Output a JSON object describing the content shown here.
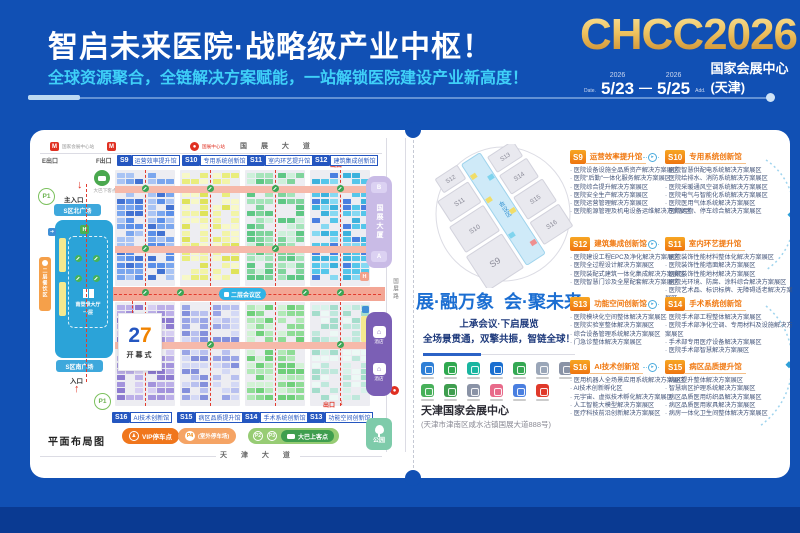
{
  "colors": {
    "bg": "#1150b4",
    "footer": "#0a3a92",
    "cyan": "#3fd0f8",
    "gold": "#e8b64f",
    "orange": "#f07810",
    "blue": "#2456c0"
  },
  "header": {
    "title": "智启未来医院·战略级产业中枢！",
    "subtitle": "全球资源聚合，全链解决方案赋能，一站解锁医院建设产业新高度！",
    "brand": "CHCC2026",
    "date_label": "Date.",
    "addr_label": "Add.",
    "year_start": "2026",
    "year_end": "2026",
    "date_start": "5/23",
    "date_sep": "—",
    "date_end": "5/25",
    "venue": "国家会展中心(天津)"
  },
  "floorplan": {
    "caption": "平面布局图",
    "roads": {
      "top": "国 展 大 道",
      "bottom": "天 津 大 道",
      "right": "国展路"
    },
    "station_label": "国家会展中心站",
    "metro_badge_label": "国展中心站",
    "exits": {
      "e": "E出口",
      "f": "F出口",
      "top": "出口",
      "bottom": "出口"
    },
    "main_entrance": "主入口",
    "south_entrance": "入口",
    "plaza_north": "S区北广场",
    "plaza_south": "S区南广场",
    "drop_off": "大巴下客点",
    "registration_line1": "南登录大厅",
    "registration_line2": "一层",
    "dining": "二层餐饮区",
    "corridor": "二层会议区",
    "opening": {
      "num_left": "2",
      "num_right": "7",
      "label": "开幕式"
    },
    "tower": {
      "b": "B",
      "name": "国展大厦",
      "a": "A"
    },
    "hotel_label": "酒店",
    "park": "公园",
    "parking": "P1",
    "legend": {
      "vip": "VIP停车点",
      "p4": "P4",
      "p4_note": "(室外停车场)",
      "p2": "P2",
      "p3": "P3",
      "bus": "大巴上客点"
    },
    "halls_top": [
      {
        "id": "S9",
        "name": "运营效率提升馆"
      },
      {
        "id": "S10",
        "name": "专用系统创新馆"
      },
      {
        "id": "S11",
        "name": "室内环艺提升馆"
      },
      {
        "id": "S12",
        "name": "建筑集成创新馆"
      }
    ],
    "halls_bottom": [
      {
        "id": "S16",
        "name": "AI技术创新馆"
      },
      {
        "id": "S15",
        "name": "病区品质提升馆"
      },
      {
        "id": "S14",
        "name": "手术系统创新馆"
      },
      {
        "id": "S13",
        "name": "功能空间创新馆"
      }
    ],
    "hall_palettes": {
      "S9": [
        "#5b8fe8",
        "#7aa6ee",
        "#4272d2",
        "#a9c4f4"
      ],
      "S10": [
        "#e9ed7d",
        "#f2f4a8",
        "#dfe35c",
        "#f7f8c8"
      ],
      "S11": [
        "#7fd49c",
        "#a5e4ba",
        "#5fc785",
        "#cdf0da"
      ],
      "S12": [
        "#55c6ea",
        "#86d9f2",
        "#3db2dd",
        "#4a7fe0"
      ],
      "S16": [
        "#a393dc",
        "#bcafe8",
        "#8d7bd0",
        "#d6cef2"
      ],
      "S15": [
        "#9aa5e6",
        "#b8c0ef",
        "#8490dc",
        "#d4d9f5"
      ],
      "S14": [
        "#8fdc96",
        "#b2e9b7",
        "#6fcf7a",
        "#d2f2d5"
      ],
      "S13": [
        "#bfe8dc",
        "#d8f2ea",
        "#a5ddcc",
        "#ecf9f5"
      ]
    }
  },
  "middle": {
    "slogan_left": "展·融万象",
    "slogan_right": "会·聚未来",
    "sub1": "上承会议·下启展览",
    "sub2": "全场景贯通，双擎共振，智链全球！",
    "venue_name": "天津国家会展中心",
    "venue_addr": "(天津市津南区咸水沽镇国展大道888号)",
    "minimap_center": "会议区",
    "minimap_labels": [
      "S9",
      "S10",
      "S11",
      "S12",
      "S13",
      "S14",
      "S15",
      "S16"
    ],
    "icon_colors_row1": [
      "#2e7fd6",
      "#2fa84f",
      "#19b5a0",
      "#1a6fd0",
      "#34a853",
      "#9aa6b8",
      "#8a93a6"
    ],
    "icon_colors_row2": [
      "#47b05a",
      "#3f9e4f",
      "#8a93a6",
      "#e86a8a",
      "#4a7fe0",
      "#e0392a"
    ]
  },
  "hall_list": {
    "rows": [
      [
        {
          "id": "S9",
          "name": "运营效率提升馆",
          "items": [
            "医院设备设施全品质资产解决方案展区",
            "医院\"后勤\"一体化服务解决方案展区",
            "医院综合提升解决方案展区",
            "医院安全生产解决方案展区",
            "医院运营管理解决方案展区",
            "医院能源管理及机电设备运维解决方案展区"
          ]
        },
        {
          "id": "S10",
          "name": "专用系统创新馆",
          "items": [
            "医院智慧供配电系统解决方案展区",
            "医院给排水、消防系统解决方案展区",
            "医院采暖通风空调系统解决方案展区",
            "医院电气与智能化系统解决方案展区",
            "医院医用气体系统解决方案展区",
            "医院污物、停车综合解决方案展区"
          ]
        }
      ],
      [
        {
          "id": "S12",
          "name": "建筑集成创新馆",
          "items": [
            "医院建设工程EPC及净化解决方案展区",
            "医院全过程设计解决方案展区",
            "医院装配式建筑一体化集成解决方案展区",
            "医院智慧门诊及全屋配套解决方案展区"
          ]
        },
        {
          "id": "S11",
          "name": "室内环艺提升馆",
          "items": [
            "医院装饰性能材料整体化解决方案展区",
            "医院装饰性能墙面解决方案展区",
            "医院装饰性能地材解决方案展区",
            "医院光环境、防腐、涂料综合解决方案展区",
            "医院艺术品、标识标牌、无障碍适老解决方案展区"
          ]
        }
      ],
      [
        {
          "id": "S13",
          "name": "功能空间创新馆",
          "items": [
            "医院模块化空间整体解决方案展区",
            "医院实验室整体解决方案展区",
            "综合设备管理系统解决方案展区",
            "门急诊整体解决方案展区"
          ]
        },
        {
          "id": "S14",
          "name": "手术系统创新馆",
          "items": [
            "医院手术部工程整体解决方案展区",
            "医院手术部净化空调、专用材料及设施解决方案展区",
            "手术部专用医疗设备解决方案展区",
            "医院手术部智慧解决方案展区"
          ]
        }
      ],
      [
        {
          "id": "S16",
          "name": "AI技术创新馆",
          "items": [
            "医用机器人全场景应用系统解决方案展区",
            "AI技术创新孵化区",
            "元宇宙、虚拟技术孵化解决方案展区",
            "人工智能大模型解决方案展区",
            "医疗科技前沿创新解决方案展区"
          ]
        },
        {
          "id": "S15",
          "name": "病区品质提升馆",
          "items": [
            "病区提升整体解决方案展区",
            "智慧病区护理系统解决方案展区",
            "病区品质医用纺织品解决方案展区",
            "病区品质医用家具解决方案展区",
            "病房一体化卫生间整体解决方案展区"
          ]
        }
      ]
    ]
  }
}
